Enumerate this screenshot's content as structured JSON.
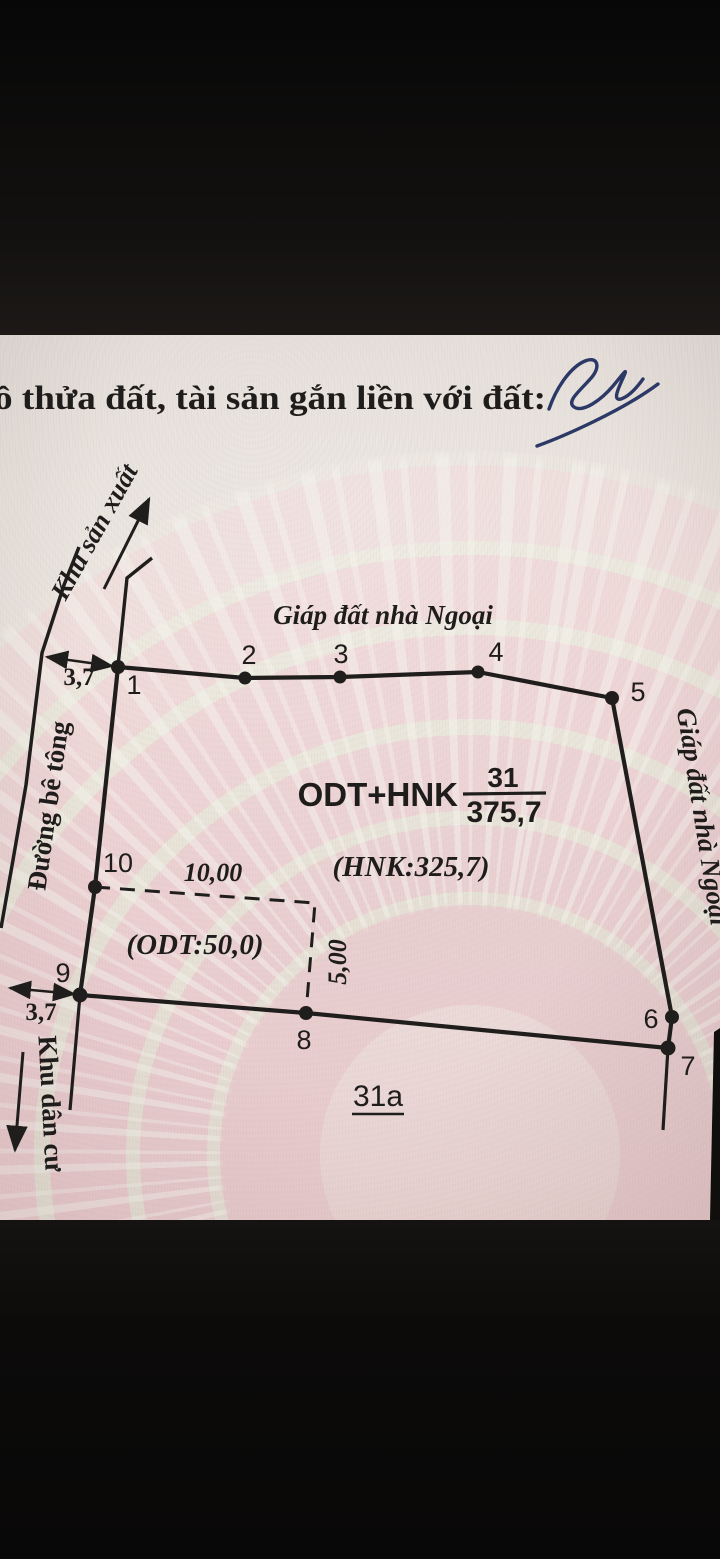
{
  "title": "ồ thửa đất, tài sản gắn liền với đất:",
  "diagram": {
    "neighbors": {
      "top": "Giáp đất nhà Ngoại",
      "right": "Giáp đất nhà Ngoại"
    },
    "zones": {
      "production": "Khu sản xuất",
      "residential": "Khu dân cư"
    },
    "road": "Đường bê tông",
    "parcel": {
      "land_use": "ODT+HNK",
      "parcel_number": "31",
      "area": "375,7",
      "hnk_area": "(HNK:325,7)",
      "odt_area": "(ODT:50,0)",
      "adjacent_parcel": "31a"
    },
    "vertices": [
      {
        "label": "1"
      },
      {
        "label": "2"
      },
      {
        "label": "3"
      },
      {
        "label": "4"
      },
      {
        "label": "5"
      },
      {
        "label": "6"
      },
      {
        "label": "7"
      },
      {
        "label": "8"
      },
      {
        "label": "9"
      },
      {
        "label": "10"
      }
    ],
    "dimensions": {
      "top_offset": "3,7",
      "bottom_offset": "3,7",
      "odt_width": "10,00",
      "odt_depth": "5,00"
    }
  },
  "colors": {
    "ink": "#201e1c",
    "signature_ink": "#2c3866",
    "paper": "#e7e0da",
    "pattern_pink": "#ecc9cc",
    "letterbox": "#0d0c0b"
  }
}
